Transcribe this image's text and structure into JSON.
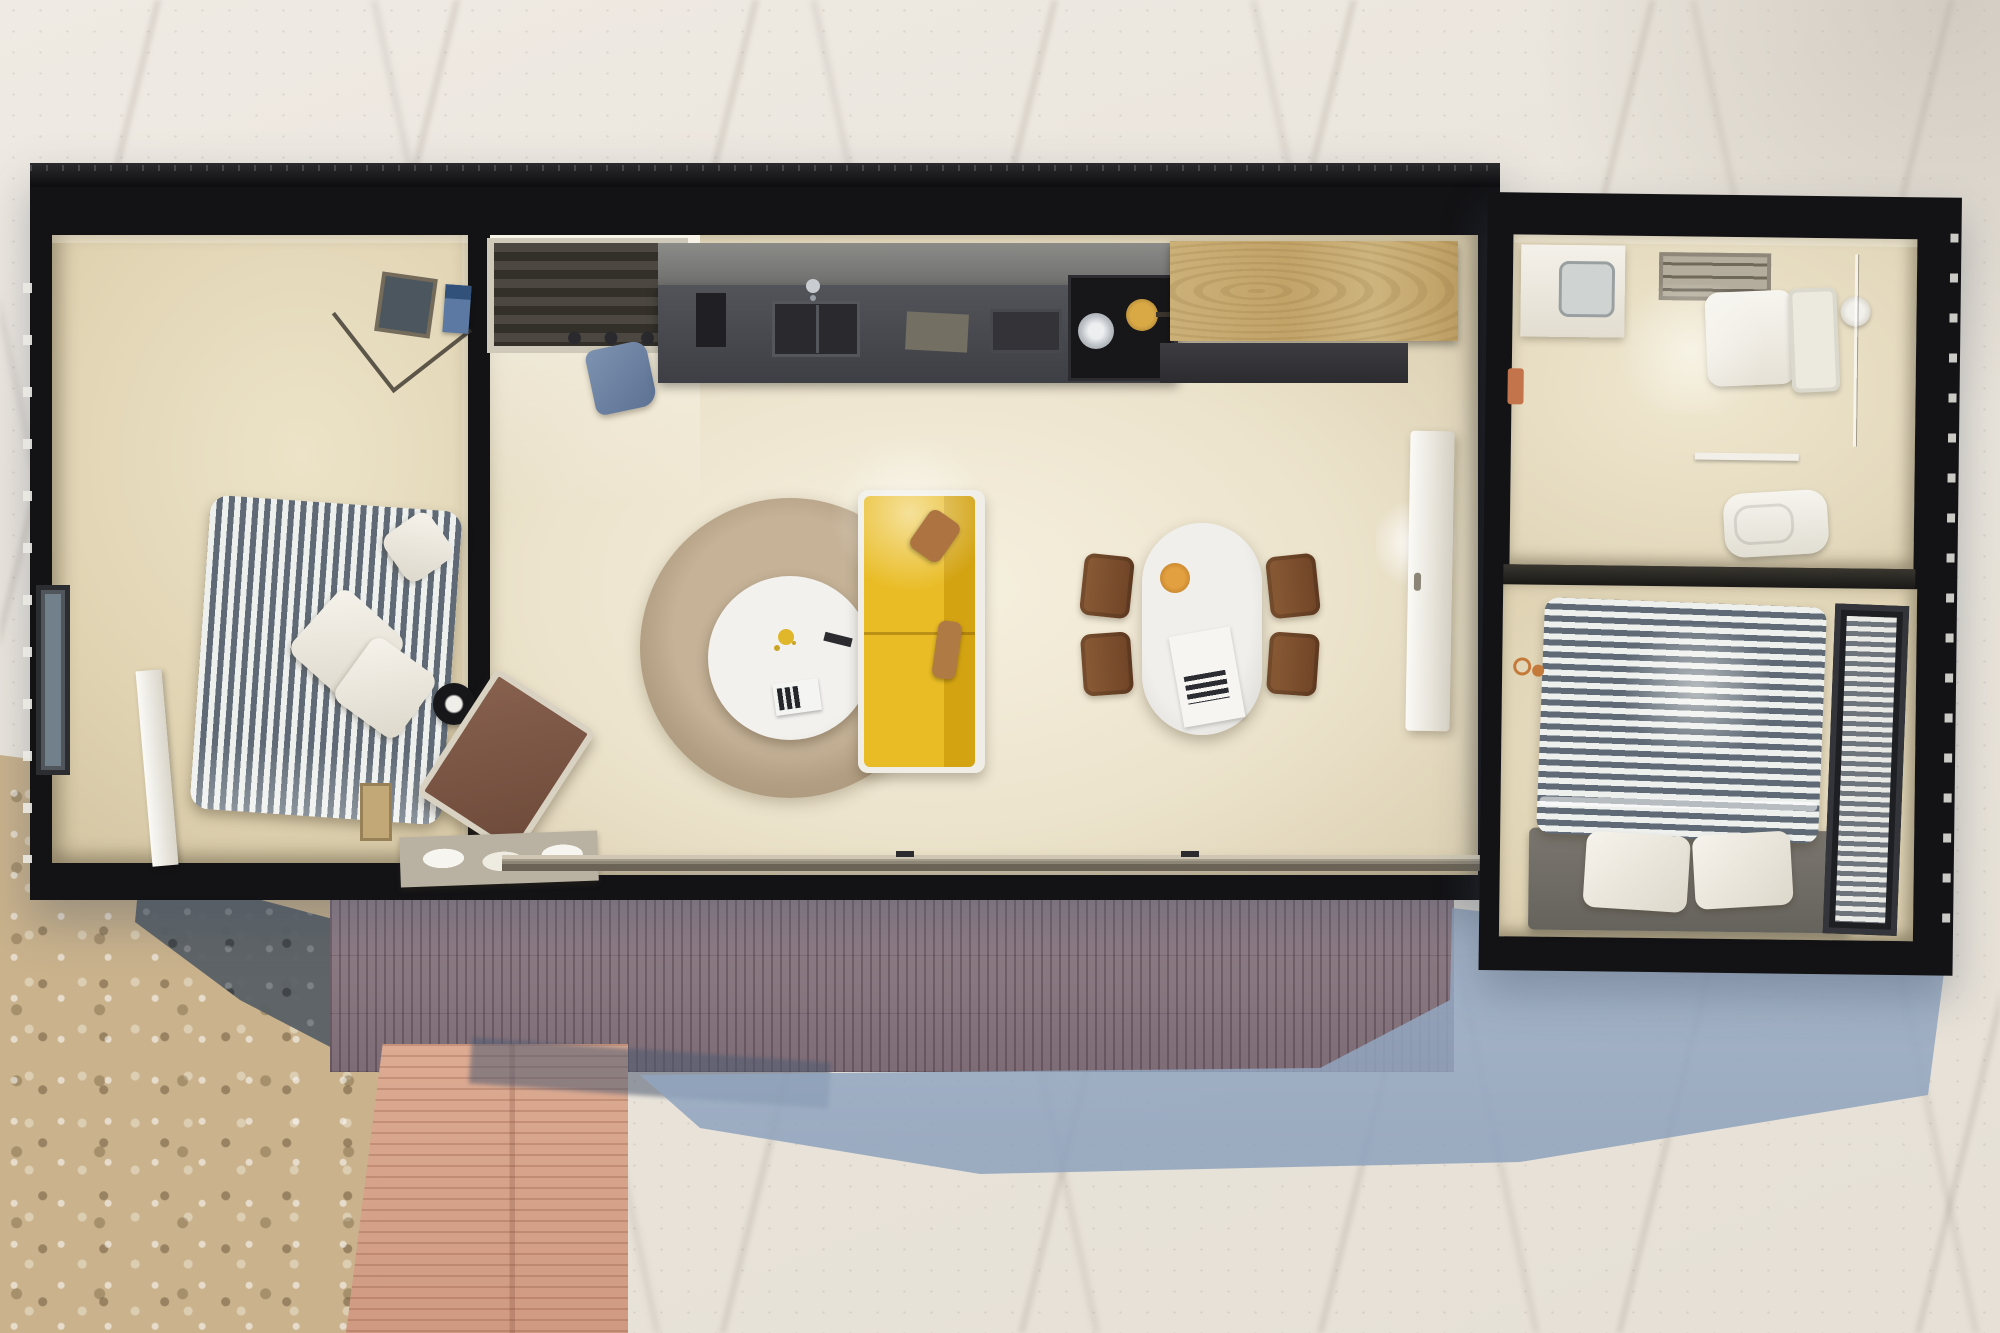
{
  "scene": {
    "title": "Top-down 3D architectural floor-plan render of a rectangular container-style tiny home on sandy rocky terrain",
    "view": "overhead dollhouse render",
    "has_text": false
  },
  "palette": {
    "sand": "#e9e4db",
    "sand_vein": "#968c80",
    "rock_pebble": "#c9b28c",
    "rock_dark": "#596066",
    "deck_wood_purple": "#8a7881",
    "deck_wood_pink": "#d6a58c",
    "cast_shadow_blue": "#93a7c1",
    "wall_black": "#131316",
    "floor_cream": "#ece3cc",
    "floor_tan": "#e0d3b2",
    "kitchen_counter_gray": "#47474d",
    "cabinet_wood": "#c6a873",
    "sofa_yellow": "#e9bc25",
    "sofa_pillow_brown": "#ad7340",
    "rug_tan": "#b8a489",
    "table_white": "#f0efec",
    "chair_brown": "#7d5030",
    "bed_stripe_dark": "#5f6a76",
    "bed_stripe_light": "#eef0ee",
    "bed_platform_gray": "#706c66",
    "bag_blue": "#6d82a2",
    "bowl_orange": "#d89a3c",
    "fixture_white": "#f4f1ea"
  },
  "terrain": {
    "items": [
      {
        "name": "sand-ground",
        "label": "Light sandy ground with marble-like veins"
      },
      {
        "name": "rock-field",
        "label": "Pebbly rock field, bottom-left"
      },
      {
        "name": "dark-rock-band",
        "label": "Dark rock / shadow band"
      },
      {
        "name": "main-deck",
        "label": "Weathered purple-brown plank deck below house"
      },
      {
        "name": "side-deck",
        "label": "Pink timber walkway deck, lower left"
      },
      {
        "name": "house-shadow",
        "label": "Blue-grey cast shadow on sand"
      }
    ]
  },
  "house": {
    "modules": [
      {
        "name": "module-main",
        "label": "Main module: bedroom 1, entry, kitchen, living-dining"
      },
      {
        "name": "module-annex",
        "label": "Annex module: bathroom and bedroom 2"
      }
    ],
    "rooms": [
      {
        "name": "bedroom-left",
        "label": "Bedroom 1",
        "furniture": [
          "double bed with blue-white striped duvet",
          "three white pillows",
          "corner wire shelf with blue books",
          "side window",
          "open white window sash",
          "timber stool"
        ]
      },
      {
        "name": "entry",
        "label": "Entry nook",
        "furniture": [
          "recessed slatted closet",
          "coat hooks",
          "blue bag"
        ]
      },
      {
        "name": "kitchen",
        "label": "Kitchen",
        "furniture": [
          "dark counter",
          "double sink with faucet",
          "coffee machine",
          "cutting board",
          "tray",
          "cooktop with steel pot and brass pan",
          "light-wood cabinet",
          "dark bench"
        ]
      },
      {
        "name": "living-dining",
        "label": "Living / dining room",
        "furniture": [
          "round tan rug",
          "round white coffee table with flowers, remote and magazines",
          "yellow two-seat sofa with brown pillows",
          "brown lounge chair",
          "black round side table",
          "tray with folded blankets",
          "oval white dining table with orange bowl and paper",
          "four brown chairs",
          "open white interior door",
          "wall lamp",
          "sliding glass door track"
        ]
      },
      {
        "name": "bathroom",
        "label": "Bathroom",
        "furniture": [
          "white vanity sink",
          "ceiling vent",
          "toilet with tank",
          "shower head and glass screen",
          "towel rail",
          "bidet",
          "orange hand towel"
        ]
      },
      {
        "name": "bedroom-right",
        "label": "Bedroom 2",
        "furniture": [
          "double bed with striped duvet",
          "two white pillows",
          "grey bed platform",
          "side window with blinds",
          "orange reading glasses"
        ]
      }
    ]
  }
}
